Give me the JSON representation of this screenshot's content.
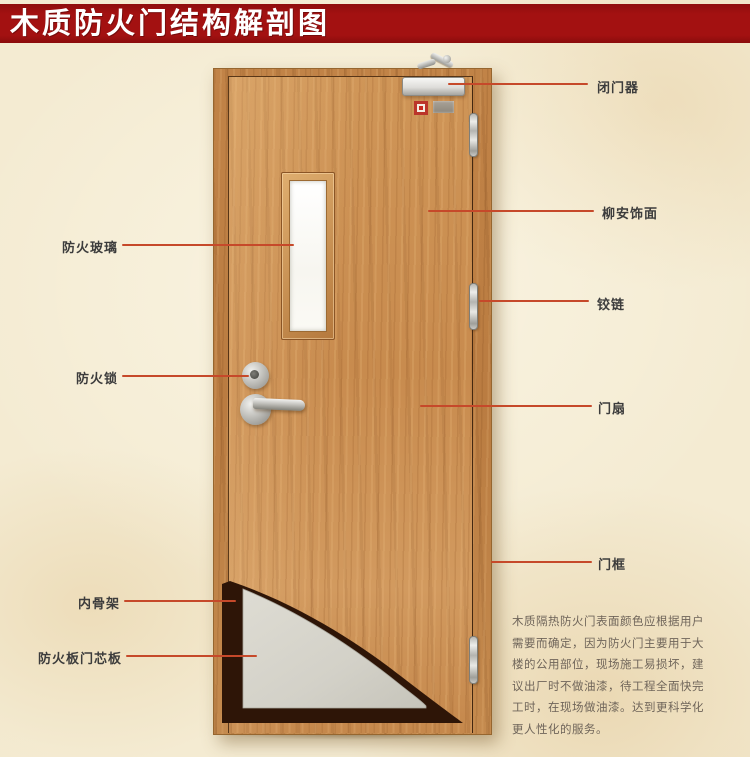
{
  "banner": {
    "title": "木质防火门结构解剖图"
  },
  "annotations": {
    "right": [
      {
        "id": "door-closer",
        "label": "闭门器"
      },
      {
        "id": "lauan-veneer",
        "label": "柳安饰面"
      },
      {
        "id": "hinge",
        "label": "铰链"
      },
      {
        "id": "door-leaf",
        "label": "门扇"
      },
      {
        "id": "door-frame",
        "label": "门框"
      }
    ],
    "left": [
      {
        "id": "fire-glass",
        "label": "防火玻璃"
      },
      {
        "id": "fire-lock",
        "label": "防火锁"
      },
      {
        "id": "inner-skeleton",
        "label": "内骨架"
      },
      {
        "id": "fire-board-core",
        "label": "防火板门芯板"
      }
    ]
  },
  "description": {
    "lines": [
      "木质隔热防火门表面颜色应根据用户",
      "需要而确定，因为防火门主要用于大",
      "楼的公用部位，现场施工易损坏，建",
      "议出厂时不做油漆，待工程全面快完",
      "工时，在现场做油漆。达到更科学化",
      "更人性化的服务。"
    ]
  },
  "colors": {
    "banner_bg": "#a31111",
    "banner_text": "#ffffff",
    "leader_line": "#c6492a",
    "label_text": "#3c3c3c",
    "door_wood": "#cf9557",
    "frame_wood": "#ba7c41",
    "core_gray": "#d5d3ca",
    "skeleton_dark": "#2e1507",
    "glass": "#fbfaf5",
    "paper": "#f4ebd2"
  }
}
